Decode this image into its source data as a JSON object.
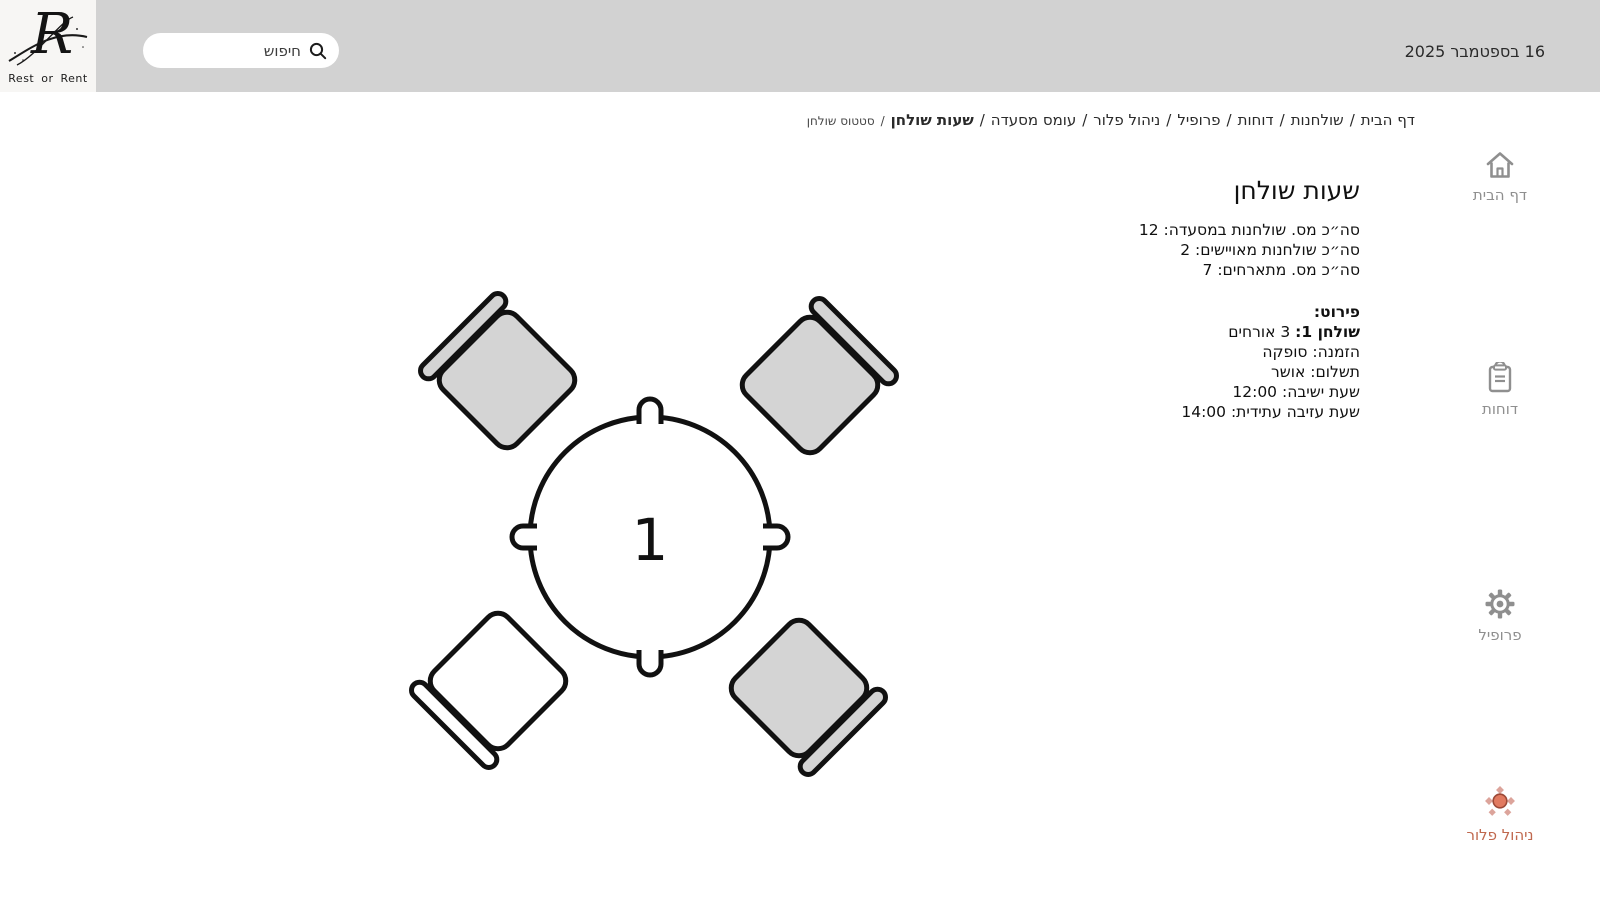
{
  "header": {
    "logo": {
      "monogram": "R",
      "caption": "Rest or Rent"
    },
    "search": {
      "placeholder": "חיפוש"
    },
    "date": "16 בספטמבר 2025"
  },
  "breadcrumb": {
    "separator": "/",
    "items": [
      {
        "label": "דף הבית"
      },
      {
        "label": "שולחנות"
      },
      {
        "label": "דוחות"
      },
      {
        "label": "פרופיל"
      },
      {
        "label": "ניהול פלור"
      },
      {
        "label": "עומס מסעדה"
      },
      {
        "label": "שעות שולחן"
      },
      {
        "label": "סטטוס שולחן"
      }
    ]
  },
  "content": {
    "title": "שעות שולחן",
    "summary": [
      "סה״כ מס. שולחנות במסעדה: 12",
      "סה״כ שולחנות מאויישים: 2",
      "סה״כ מס. מתארחים: 7"
    ],
    "details": {
      "heading": "פירוט:",
      "table_label": "שולחן 1:",
      "table_value": " 3 אורחים",
      "rows": [
        "הזמנה: סופקה",
        "תשלום: אושר",
        "שעת ישיבה: 12:00",
        "שעת עזיבה עתידית: 14:00"
      ]
    }
  },
  "sidebar": {
    "items": [
      {
        "label": "דף הבית",
        "icon": "home-icon"
      },
      {
        "label": "דוחות",
        "icon": "clipboard-icon"
      },
      {
        "label": "פרופיל",
        "icon": "gear-icon"
      },
      {
        "label": "ניהול פלור",
        "icon": "floor-table-icon",
        "active": true
      }
    ]
  },
  "floor": {
    "table_number": "1",
    "chairs": [
      {
        "position": "top-left",
        "fill": "#d4d4d4"
      },
      {
        "position": "top-right",
        "fill": "#d4d4d4"
      },
      {
        "position": "bottom-left",
        "fill": "#ffffff"
      },
      {
        "position": "bottom-right",
        "fill": "#d4d4d4"
      }
    ]
  },
  "colors": {
    "header_bg": "#d2d2d2",
    "accent": "#c0684e",
    "accent_fill": "#e17a60",
    "nav_gray": "#8f8f8f",
    "outline": "#111111"
  }
}
